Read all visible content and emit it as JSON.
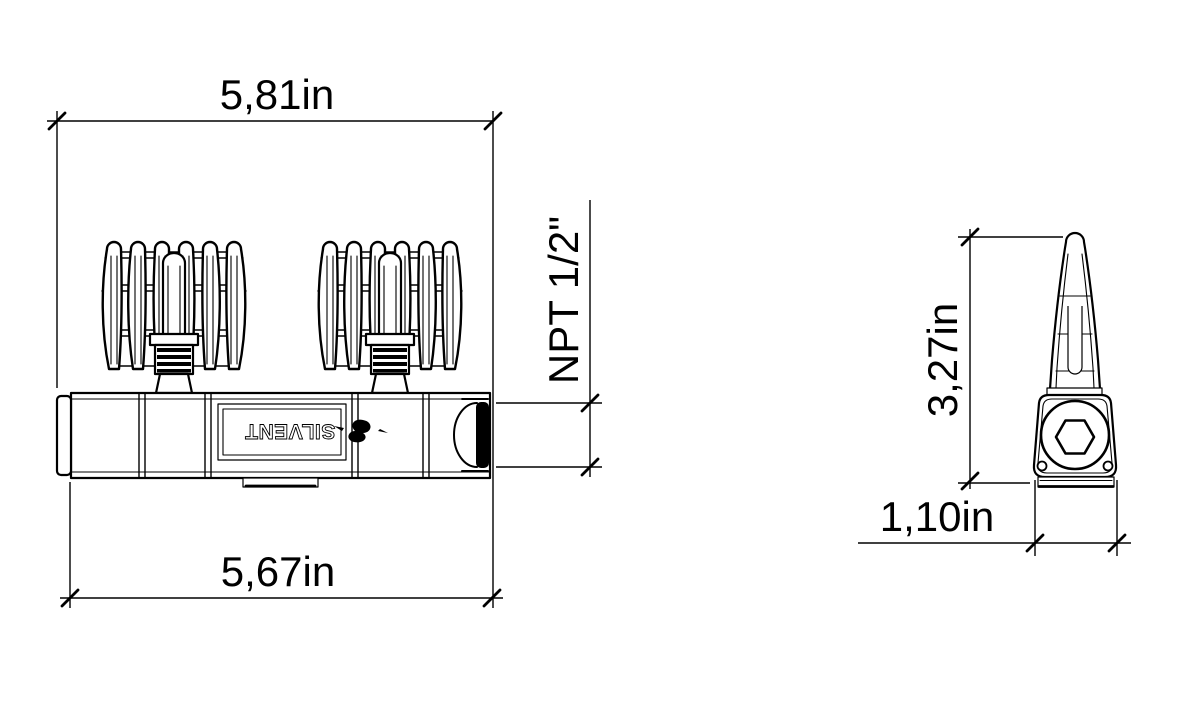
{
  "colors": {
    "line": "#000000",
    "background": "#ffffff",
    "fill": "#ffffff"
  },
  "front_view": {
    "brand_label": "SILVENT",
    "dimensions": {
      "overall_width": "5,81in",
      "body_width": "5,67in",
      "thread": "NPT 1/2\""
    }
  },
  "side_view": {
    "dimensions": {
      "overall_height": "3,27in",
      "body_depth": "1,10in"
    }
  }
}
